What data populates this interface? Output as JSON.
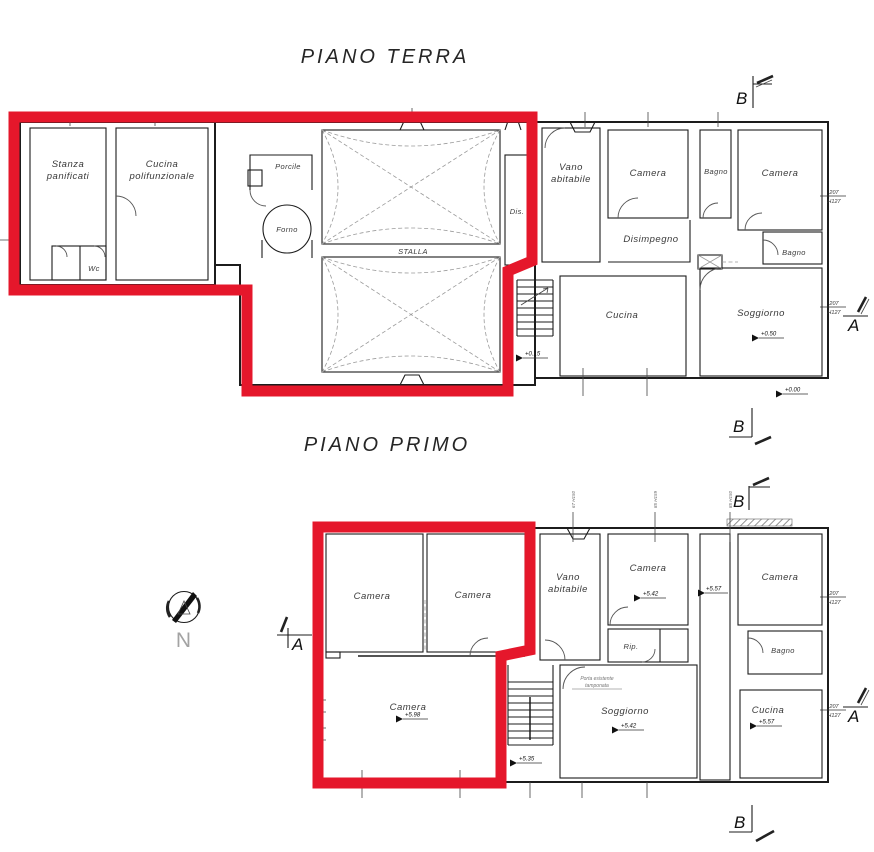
{
  "drawing": {
    "titles": {
      "ground": "PIANO TERRA",
      "first": "PIANO PRIMO"
    },
    "compass_label": "N",
    "section_markers": {
      "a": "A",
      "b": "B"
    },
    "colors": {
      "highlight": "#e5172b",
      "line": "#1c1c1c",
      "detail_gray": "#9a9a9a"
    },
    "ground_floor": {
      "rooms": {
        "stanza_panificati": [
          "Stanza",
          "panificati"
        ],
        "cucina_polifunzionale": [
          "Cucina",
          "polifunzionale"
        ],
        "wc": "Wc",
        "porcile": "Porcile",
        "forno": "Forno",
        "stalla": "STALLA",
        "dis": "Dis.",
        "vano_abitabile": [
          "Vano",
          "abitabile"
        ],
        "camera_1": "Camera",
        "bagno_1": "Bagno",
        "camera_2": "Camera",
        "disimpegno": "Disimpegno",
        "bagno_2": "Bagno",
        "cucina": "Cucina",
        "soggiorno": "Soggiorno"
      },
      "levels": {
        "stairs": "+0.15",
        "soggiorno": "+0.50",
        "exterior": "+0.00"
      },
      "windows": {
        "right_upper": [
          "207",
          "H127"
        ],
        "right_lower": [
          "207",
          "H127"
        ]
      }
    },
    "first_floor": {
      "rooms": {
        "camera_tl": "Camera",
        "camera_tm": "Camera",
        "camera_big": "Camera",
        "vano_abitabile": [
          "Vano",
          "abitabile"
        ],
        "camera_mid": "Camera",
        "rip": "Rip.",
        "bagno": "Bagno",
        "camera_right": "Camera",
        "soggiorno": "Soggiorno",
        "cucina": "Cucina"
      },
      "levels": {
        "camera_big": "+5.98",
        "stairs": "+5.35",
        "camera_mid": "+5.42",
        "corridor": "+5.57",
        "soggiorno": "+5.42",
        "cucina": "+5.57"
      },
      "note": [
        "Porta esistente",
        "tamponata"
      ],
      "window_ticks": [
        "67 H150",
        "85 H159",
        "85 H150"
      ],
      "windows": {
        "right_upper": [
          "207",
          "H127"
        ],
        "right_lower": [
          "207",
          "H127"
        ]
      }
    }
  }
}
